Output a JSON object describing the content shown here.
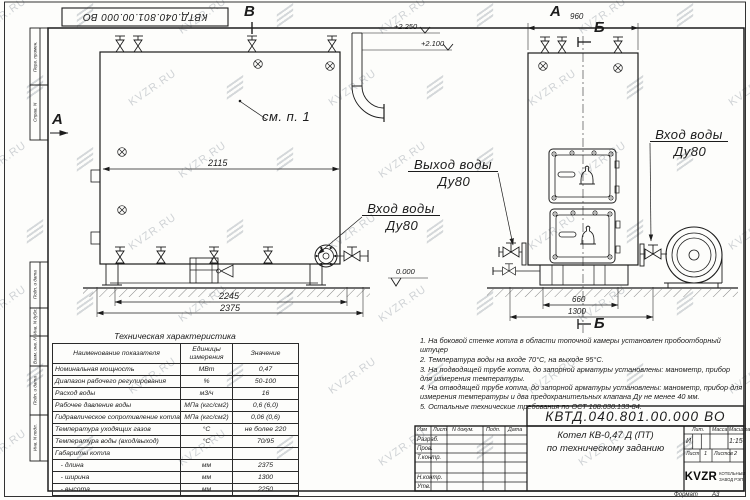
{
  "watermark": {
    "text": "KVZR.RU"
  },
  "doc": {
    "number": "КВТД.040.801.00.000  ВО"
  },
  "frame": {
    "side_labels": [
      "Перв. примен.",
      "Справ. N",
      "Подп. и дата",
      "Инв. N дубл.",
      "Взам. инв. N",
      "Подп. и дата",
      "Инв. N подл."
    ],
    "format_label": "Формат",
    "format_value": "А3"
  },
  "drawing": {
    "markers": {
      "view_b_top": "В",
      "view_a_left": "А",
      "view_a_right": "А",
      "section_b_top": "Б",
      "section_b_bottom": "Б"
    },
    "levels": {
      "l1": "+2.250",
      "l2": "+2.100",
      "zero": "0.000"
    },
    "dims": {
      "d2115": "2115",
      "d2245": "2245",
      "d2375": "2375",
      "d960": "960",
      "d660": "660",
      "d1300": "1300"
    },
    "labels": {
      "see_note": "см. п. 1",
      "outlet": "Выход воды",
      "inlet": "Вход воды",
      "dn": "Ду80"
    }
  },
  "spec_table": {
    "title": "Техническая характеристика",
    "headers": [
      "Наименование показателя",
      "Единицы измерения",
      "Значение"
    ],
    "rows": [
      [
        "Номинальная мощность",
        "МВт",
        "0,47"
      ],
      [
        "Диапазон рабочего регулирования",
        "%",
        "50-100"
      ],
      [
        "Расход воды",
        "м3/ч",
        "16"
      ],
      [
        "Рабочее давление воды",
        "МПа (кгс/см2)",
        "0,6 (6,0)"
      ],
      [
        "Гидравлическое сопротивление котла",
        "МПа (кгс/см2)",
        "0,06 (0,6)"
      ],
      [
        "Температура уходящих газов",
        "°С",
        "не более 220"
      ],
      [
        "Температура воды (вход/выход)",
        "°С",
        "70/95"
      ],
      [
        "Габариты котла",
        "",
        ""
      ],
      [
        "   - длина",
        "мм",
        "2375"
      ],
      [
        "   - ширина",
        "мм",
        "1300"
      ],
      [
        "   - высота",
        "мм",
        "2250"
      ]
    ]
  },
  "notes": {
    "items": [
      "1.  На боковой стенке котла в области топочной камеры установлен пробоотборный штуцер",
      "2.  Температура воды на входе 70°С, на выходе 95°С.",
      "3.  На подводящей трубе котла, до запорной арматуры установлены: манометр, прибор для измерения температуры.",
      "4.  На отводящей трубе котла, до запорной арматуры установлены: манометр, прибор для измерения температуры и два предохранительных клапана Ду не менее 40 мм.",
      "5.  Остальные технические требования по ОСТ 108.030.133-84."
    ]
  },
  "title_block": {
    "doc_number": "КВТД.040.801.00.000  ВО",
    "title_line1": "Котел  КВ-0,47 Д (ПТ)",
    "title_line2": "по техническому заданию",
    "header_cols": [
      "Изм",
      "Лист",
      "N докум.",
      "Подп.",
      "Дата"
    ],
    "row_labels": [
      "Разраб.",
      "Пров.",
      "Т.контр.",
      "",
      "Н.контр.",
      "Утв."
    ],
    "lit_label": "Лит.",
    "lit_value": "И",
    "mass_label": "Масса",
    "scale_label": "Масштаб",
    "scale_value": "1:15",
    "sheet_label": "Лист",
    "sheet_value": "1",
    "sheets_label": "Листов",
    "sheets_value": "2",
    "company_logo": "KVZR",
    "company_line1": "КОТЕЛЬНЫЙ",
    "company_line2": "ЗАВОД РЭП"
  }
}
